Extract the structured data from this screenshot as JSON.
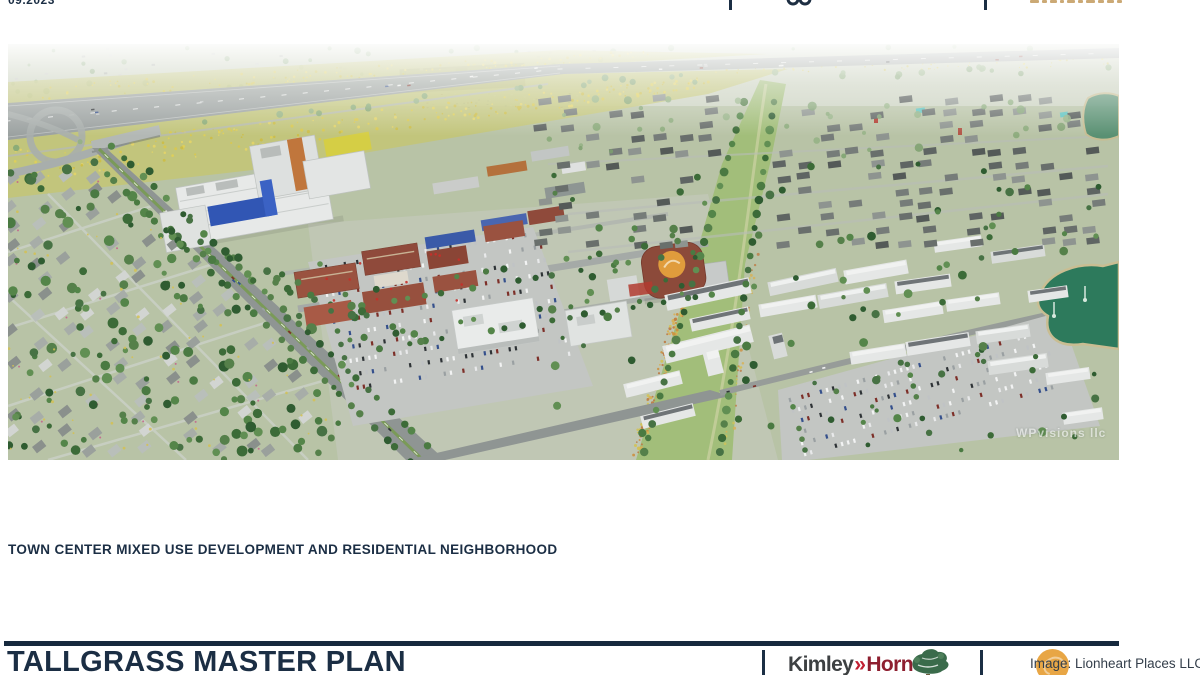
{
  "page": {
    "date": "09.2023",
    "caption": "TOWN CENTER MIXED USE DEVELOPMENT AND RESIDENTIAL NEIGHBORHOOD",
    "title": "TALLGRASS MASTER PLAN"
  },
  "figure": {
    "watermark": "WPvisions llc",
    "credit": "Image: Lionheart Places LLC"
  },
  "logos": {
    "kimley_horn": {
      "word1": "Kimley",
      "chevron": "»",
      "word2": "Horn"
    },
    "tree_logo_icon": "oak-tree-logo",
    "credit_badge_icon": "orange-circle-badge"
  },
  "colors": {
    "navy": "#1b2e44",
    "rule": "#16293d",
    "kimley_gray": "#3d4042",
    "kimley_chevron_red": "#c22033",
    "kimley_horn_red": "#8e1f30",
    "credit_text": "#333e4a",
    "credit_badge": "#e7a23c",
    "tree_logo_green": "#3a6b4b",
    "header_tan": "#c7a269"
  }
}
